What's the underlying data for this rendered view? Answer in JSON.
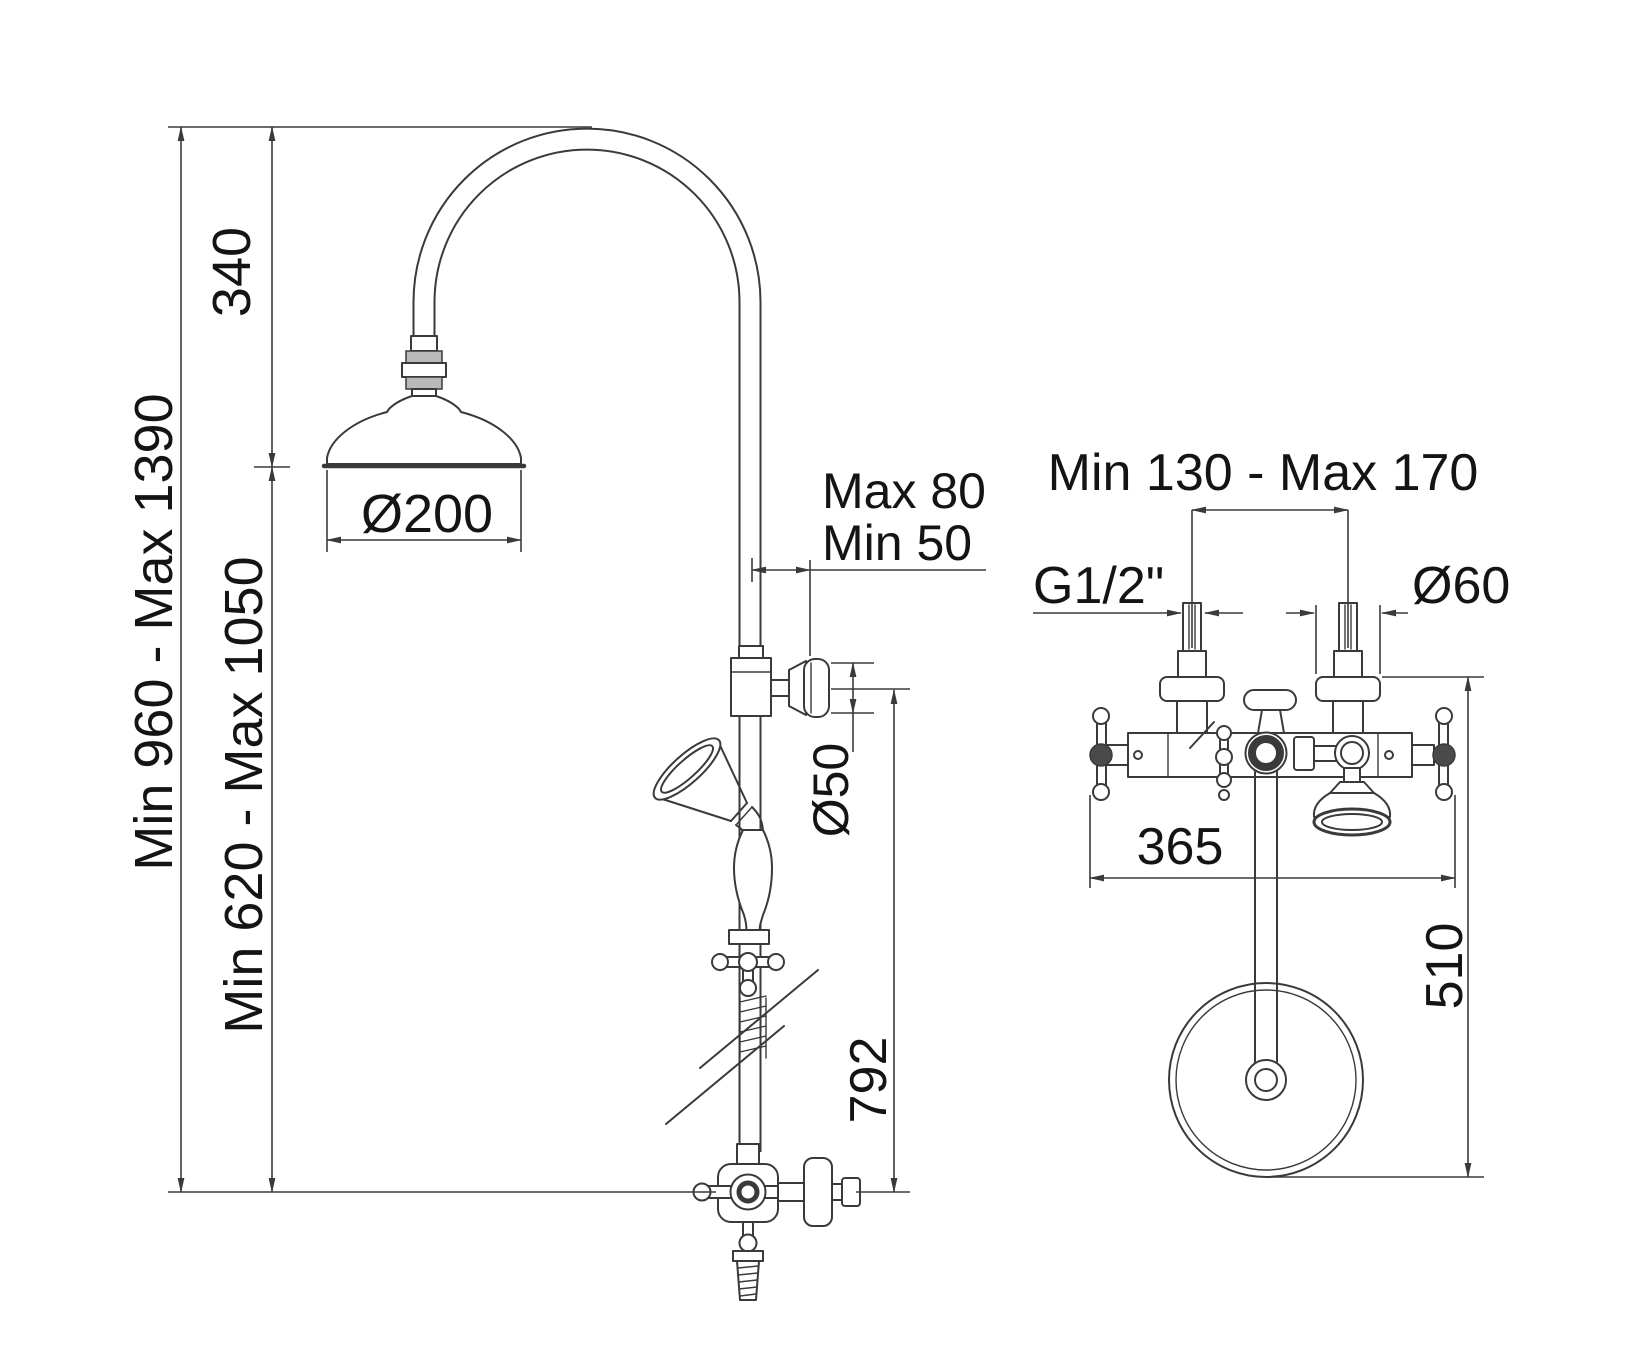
{
  "side_view": {
    "arc_height": "340",
    "overall_height": "Min 960 - Max 1390",
    "column_height": "Min 620 - Max 1050",
    "head_diameter": "Ø200",
    "wall_distance_line1": "Max 80",
    "wall_distance_line2": "Min 50",
    "bracket_flange_diameter": "Ø50",
    "bracket_to_valve_height": "792"
  },
  "front_view": {
    "inlet_spacing": "Min 130 - Max 170",
    "inlet_thread": "G1/2\"",
    "escutcheon_diameter": "Ø60",
    "body_width": "365",
    "hand_shower_drop": "510"
  },
  "colors": {
    "background": "#ffffff",
    "line": "#3a3a3a",
    "text": "#141414",
    "fill_light": "#b9b9b9"
  }
}
